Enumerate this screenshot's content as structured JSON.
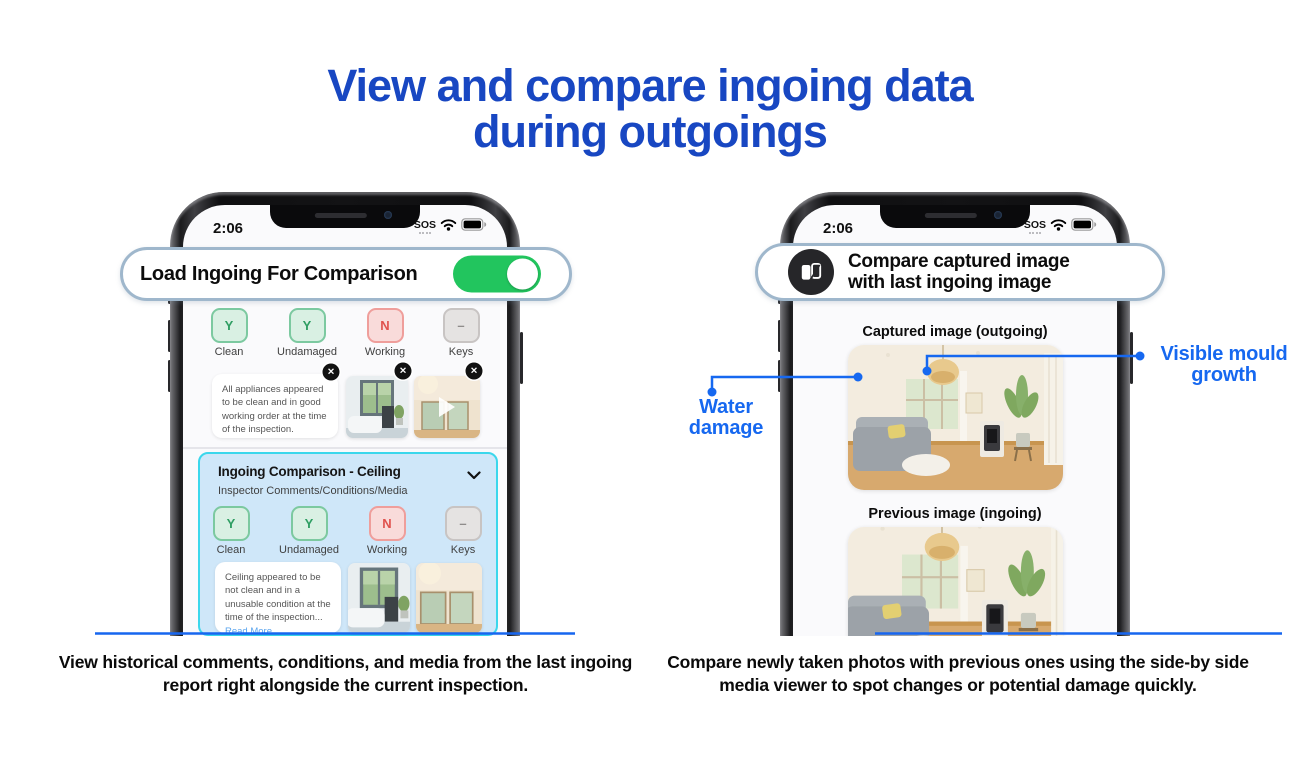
{
  "title": {
    "line1": "View and compare ingoing data",
    "line2": "during outgoings"
  },
  "colors": {
    "title_blue": "#1847C2",
    "annotation_blue": "#1668F0",
    "underline_blue": "#1766EF",
    "toggle_green": "#22C55E",
    "chip_yes_bg": "#D9F0E3",
    "chip_yes_text": "#2F9E63",
    "chip_no_bg": "#F9DBDA",
    "chip_no_text": "#E0524E",
    "chip_na_bg": "#E5E3E2",
    "chip_na_text": "#8F8C8B",
    "comparison_card_bg": "#CFE7F9",
    "comparison_card_border": "#3BD7EC",
    "callout_border": "#9FB7CC"
  },
  "icons": {
    "compare": "compare-icon",
    "wifi": "wifi-icon",
    "battery": "battery-icon",
    "close": "close-icon",
    "play": "play-icon",
    "chevron": "chevron-down-icon"
  },
  "left_phone": {
    "status_bar": {
      "time": "2:06",
      "carrier": "SOS"
    },
    "callout": {
      "label": "Load Ingoing For Comparison",
      "toggle_state": "on"
    },
    "current_section": {
      "conditions": [
        {
          "value": "Y",
          "label": "Clean"
        },
        {
          "value": "Y",
          "label": "Undamaged"
        },
        {
          "value": "N",
          "label": "Working"
        },
        {
          "value": "–",
          "label": "Keys"
        }
      ],
      "comment": "All appliances appeared to be clean and in good working order at the time of the inspection.",
      "media": [
        {
          "kind": "photo",
          "name": "bathroom-photo",
          "removable": true
        },
        {
          "kind": "video",
          "name": "living-room-video",
          "removable": true
        }
      ]
    },
    "ingoing_section": {
      "title": "Ingoing Comparison - Ceiling",
      "subtitle": "Inspector Comments/Conditions/Media",
      "conditions": [
        {
          "value": "Y",
          "label": "Clean"
        },
        {
          "value": "Y",
          "label": "Undamaged"
        },
        {
          "value": "N",
          "label": "Working"
        },
        {
          "value": "–",
          "label": "Keys"
        }
      ],
      "comment": "Ceiling appeared to be not clean and in a unusable condition at the time of the inspection...",
      "read_more": "Read More",
      "media": [
        {
          "kind": "photo",
          "name": "bathroom-photo"
        },
        {
          "kind": "photo",
          "name": "ceiling-photo"
        }
      ]
    }
  },
  "right_phone": {
    "status_bar": {
      "time": "2:06",
      "carrier": "SOS"
    },
    "callout": {
      "icon": "compare-icon",
      "line1": "Compare captured image",
      "line2": "with last ingoing image"
    },
    "captured_image_label": "Captured image (outgoing)",
    "previous_image_label": "Previous image (ingoing)",
    "annotations": [
      {
        "id": "water-damage",
        "line1": "Water",
        "line2": "damage"
      },
      {
        "id": "visible-mould-growth",
        "line1": "Visible mould",
        "line2": "growth"
      }
    ]
  },
  "captions": {
    "left": "View historical comments, conditions, and media from the last ingoing report right alongside the current inspection.",
    "right": "Compare newly taken photos with previous ones using the side-by side media viewer to spot changes or potential damage quickly."
  }
}
